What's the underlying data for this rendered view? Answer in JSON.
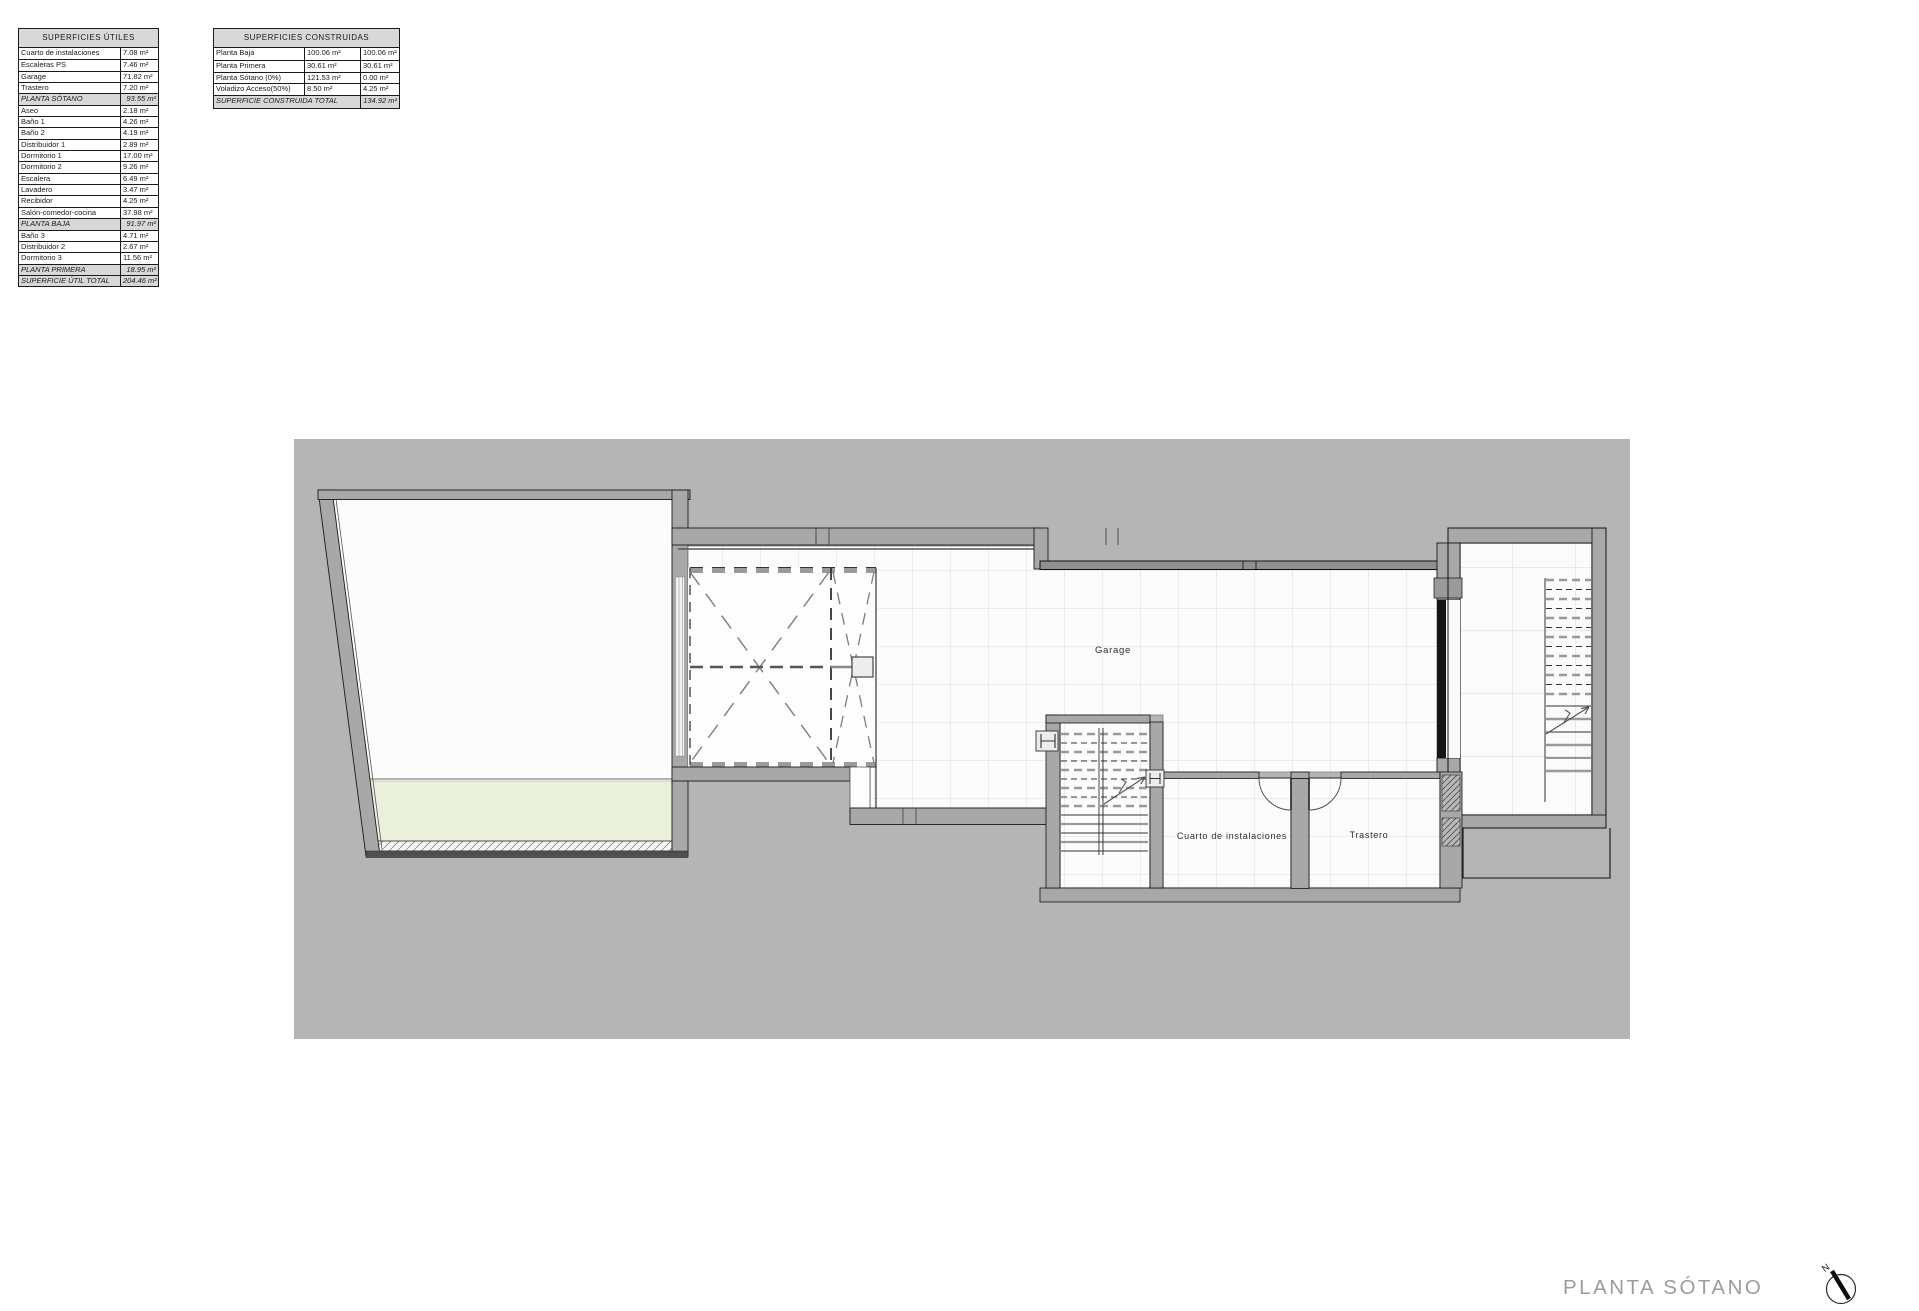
{
  "plan": {
    "title": "PLANTA SÓTANO",
    "north_label": "N",
    "rooms": {
      "garage": "Garage",
      "cuarto": "Cuarto de instalaciones",
      "trastero": "Trastero"
    }
  },
  "tables": {
    "utiles": {
      "header": "SUPERFICIES ÚTILES",
      "rows": [
        {
          "label": "Cuarto de instalaciones",
          "value": "7.08 m²",
          "type": "item"
        },
        {
          "label": "Escaleras PS",
          "value": "7.46 m²",
          "type": "item"
        },
        {
          "label": "Garage",
          "value": "71.82 m²",
          "type": "item"
        },
        {
          "label": "Trastero",
          "value": "7.20 m²",
          "type": "item"
        },
        {
          "label": "PLANTA SÓTANO",
          "value": "93.55 m²",
          "type": "subtotal"
        },
        {
          "label": "Aseo",
          "value": "2.18 m²",
          "type": "item"
        },
        {
          "label": "Baño 1",
          "value": "4.26 m²",
          "type": "item"
        },
        {
          "label": "Baño 2",
          "value": "4.19 m²",
          "type": "item"
        },
        {
          "label": "Distribuidor 1",
          "value": "2.89 m²",
          "type": "item"
        },
        {
          "label": "Dormitorio 1",
          "value": "17.00 m²",
          "type": "item"
        },
        {
          "label": "Dormitorio 2",
          "value": "9.26 m²",
          "type": "item"
        },
        {
          "label": "Escalera",
          "value": "6.49 m²",
          "type": "item"
        },
        {
          "label": "Lavadero",
          "value": "3.47 m²",
          "type": "item"
        },
        {
          "label": "Recibidor",
          "value": "4.25 m²",
          "type": "item"
        },
        {
          "label": "Salón-comedor-cocina",
          "value": "37.98 m²",
          "type": "item"
        },
        {
          "label": "PLANTA BAJA",
          "value": "91.97 m²",
          "type": "subtotal"
        },
        {
          "label": "Baño 3",
          "value": "4.71 m²",
          "type": "item"
        },
        {
          "label": "Distribuidor 2",
          "value": "2.67 m²",
          "type": "item"
        },
        {
          "label": "Dormitorio 3",
          "value": "11.56 m²",
          "type": "item"
        },
        {
          "label": "PLANTA PRIMERA",
          "value": "18.95 m²",
          "type": "subtotal"
        },
        {
          "label": "SUPERFICIE ÚTIL TOTAL",
          "value": "204.46 m²",
          "type": "total"
        }
      ]
    },
    "construidas": {
      "header": "SUPERFICIES CONSTRUIDAS",
      "rows": [
        {
          "label": "Planta Baja",
          "v1": "100.06 m²",
          "v2": "100.06 m²"
        },
        {
          "label": "Planta Primera",
          "v1": "30.61 m²",
          "v2": "30.61 m²"
        },
        {
          "label": "Planta Sótano (0%)",
          "v1": "121.53 m²",
          "v2": "0.00 m²"
        },
        {
          "label": "Voladizo Acceso(50%)",
          "v1": "8.50 m²",
          "v2": "4.25 m²"
        }
      ],
      "total_label": "SUPERFICIE CONSTRUIDA TOTAL",
      "total_value": "134.92 m²"
    }
  },
  "colors": {
    "site": "#b5b5b5",
    "wall": "#a8a8a8",
    "green": "#eaf0dc",
    "tile-line": "#dcdcdc",
    "table-gray": "#d8d8d8",
    "title-gray": "#9c9c9c"
  }
}
